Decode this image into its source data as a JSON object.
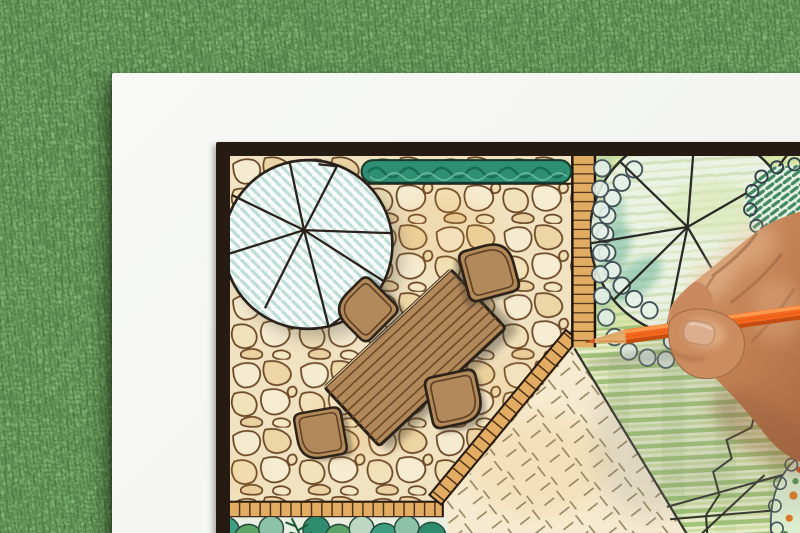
{
  "meta": {
    "type": "photograph",
    "subject": "Hand with an orange colored pencil drawing a backyard garden landscape design plan on paper lying on green grass"
  },
  "palette": {
    "grass": "#4c7c40",
    "paper": "#f4f5f3",
    "frame": "#261b12",
    "patio-stone": "#f1e3c2",
    "stone-outline": "#6b4726",
    "paver-tan": "#e2ad63",
    "hedge-green": "#2f8f74",
    "tree-hatch-cyan": "#bedcd6",
    "wood-brown": "#b2895a",
    "ink-outline": "#2c2217",
    "planting-green": "#dbe6ac",
    "lawn-green": "#e8eecb",
    "lawn-stripe": "#a3c478",
    "groundcover-cream": "#f6ead0",
    "pencil-orange": "#f3681e",
    "pencil-wood": "#e3ac6c",
    "skin-tan": "#c6875a"
  },
  "plan": {
    "elements": [
      {
        "name": "shade-tree-symbol",
        "desc": "large circle with radial spokes and cyan hatch, upper left"
      },
      {
        "name": "flagstone-patio",
        "desc": "irregular stone paving around dining set"
      },
      {
        "name": "boxwood-hedge",
        "desc": "dark green hedge strip along top edge"
      },
      {
        "name": "paver-walkway",
        "desc": "ladder-like paver strip and paver borders"
      },
      {
        "name": "outdoor-dining-table",
        "desc": "rotated plank table"
      },
      {
        "name": "dining-chairs",
        "count": 4
      },
      {
        "name": "canopy-tree-symbol",
        "desc": "circle with spokes over shrub masses, upper right"
      },
      {
        "name": "evergreen-shrub",
        "desc": "dark green hatched shrub blob"
      },
      {
        "name": "lawn-panel",
        "desc": "striped green lawn, lower right"
      },
      {
        "name": "groundcover-bed",
        "desc": "cream bed with dashed tick marks"
      },
      {
        "name": "perimeter-planting-bed",
        "desc": "scalloped plants along bottom"
      },
      {
        "name": "flower-bed",
        "desc": "dotted flower bed in lower right corner"
      }
    ]
  },
  "tools": {
    "pencil": {
      "kind": "colored pencil",
      "color_name": "orange"
    },
    "hand": {
      "side": "right",
      "action": "gripping pencil, coloring the lawn"
    }
  }
}
